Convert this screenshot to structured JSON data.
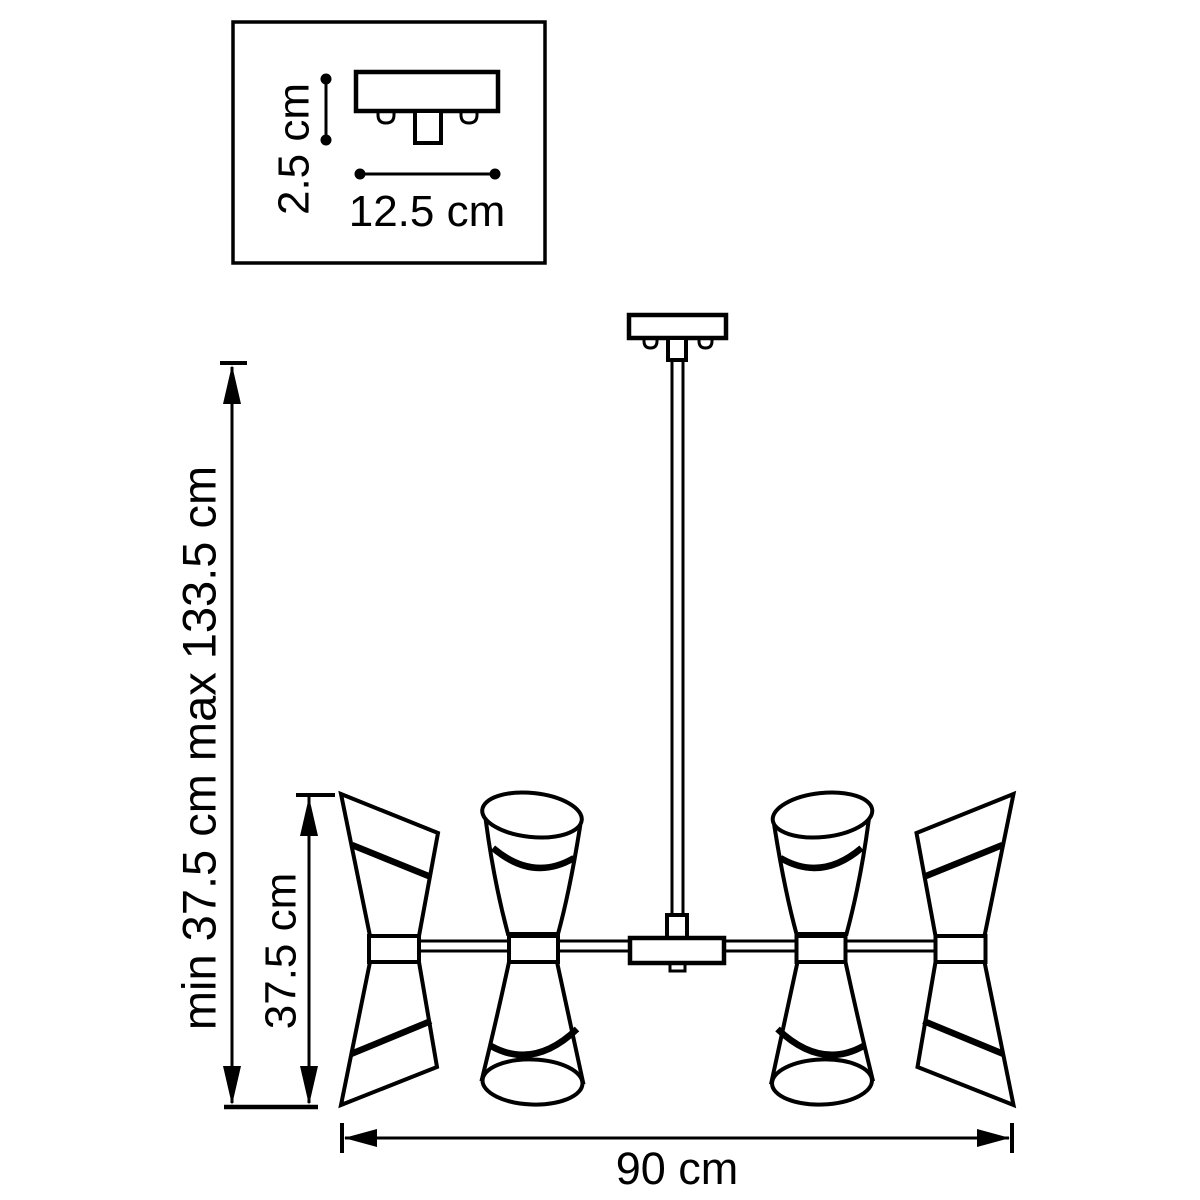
{
  "inset": {
    "height_label": "2.5 cm",
    "width_label": "12.5 cm"
  },
  "dimensions": {
    "overall_height_label": "min 37.5 cm max 133.5 cm",
    "shade_height_label": "37.5 cm",
    "width_label": "90 cm"
  },
  "colors": {
    "line": "#000000",
    "background": "#ffffff"
  }
}
